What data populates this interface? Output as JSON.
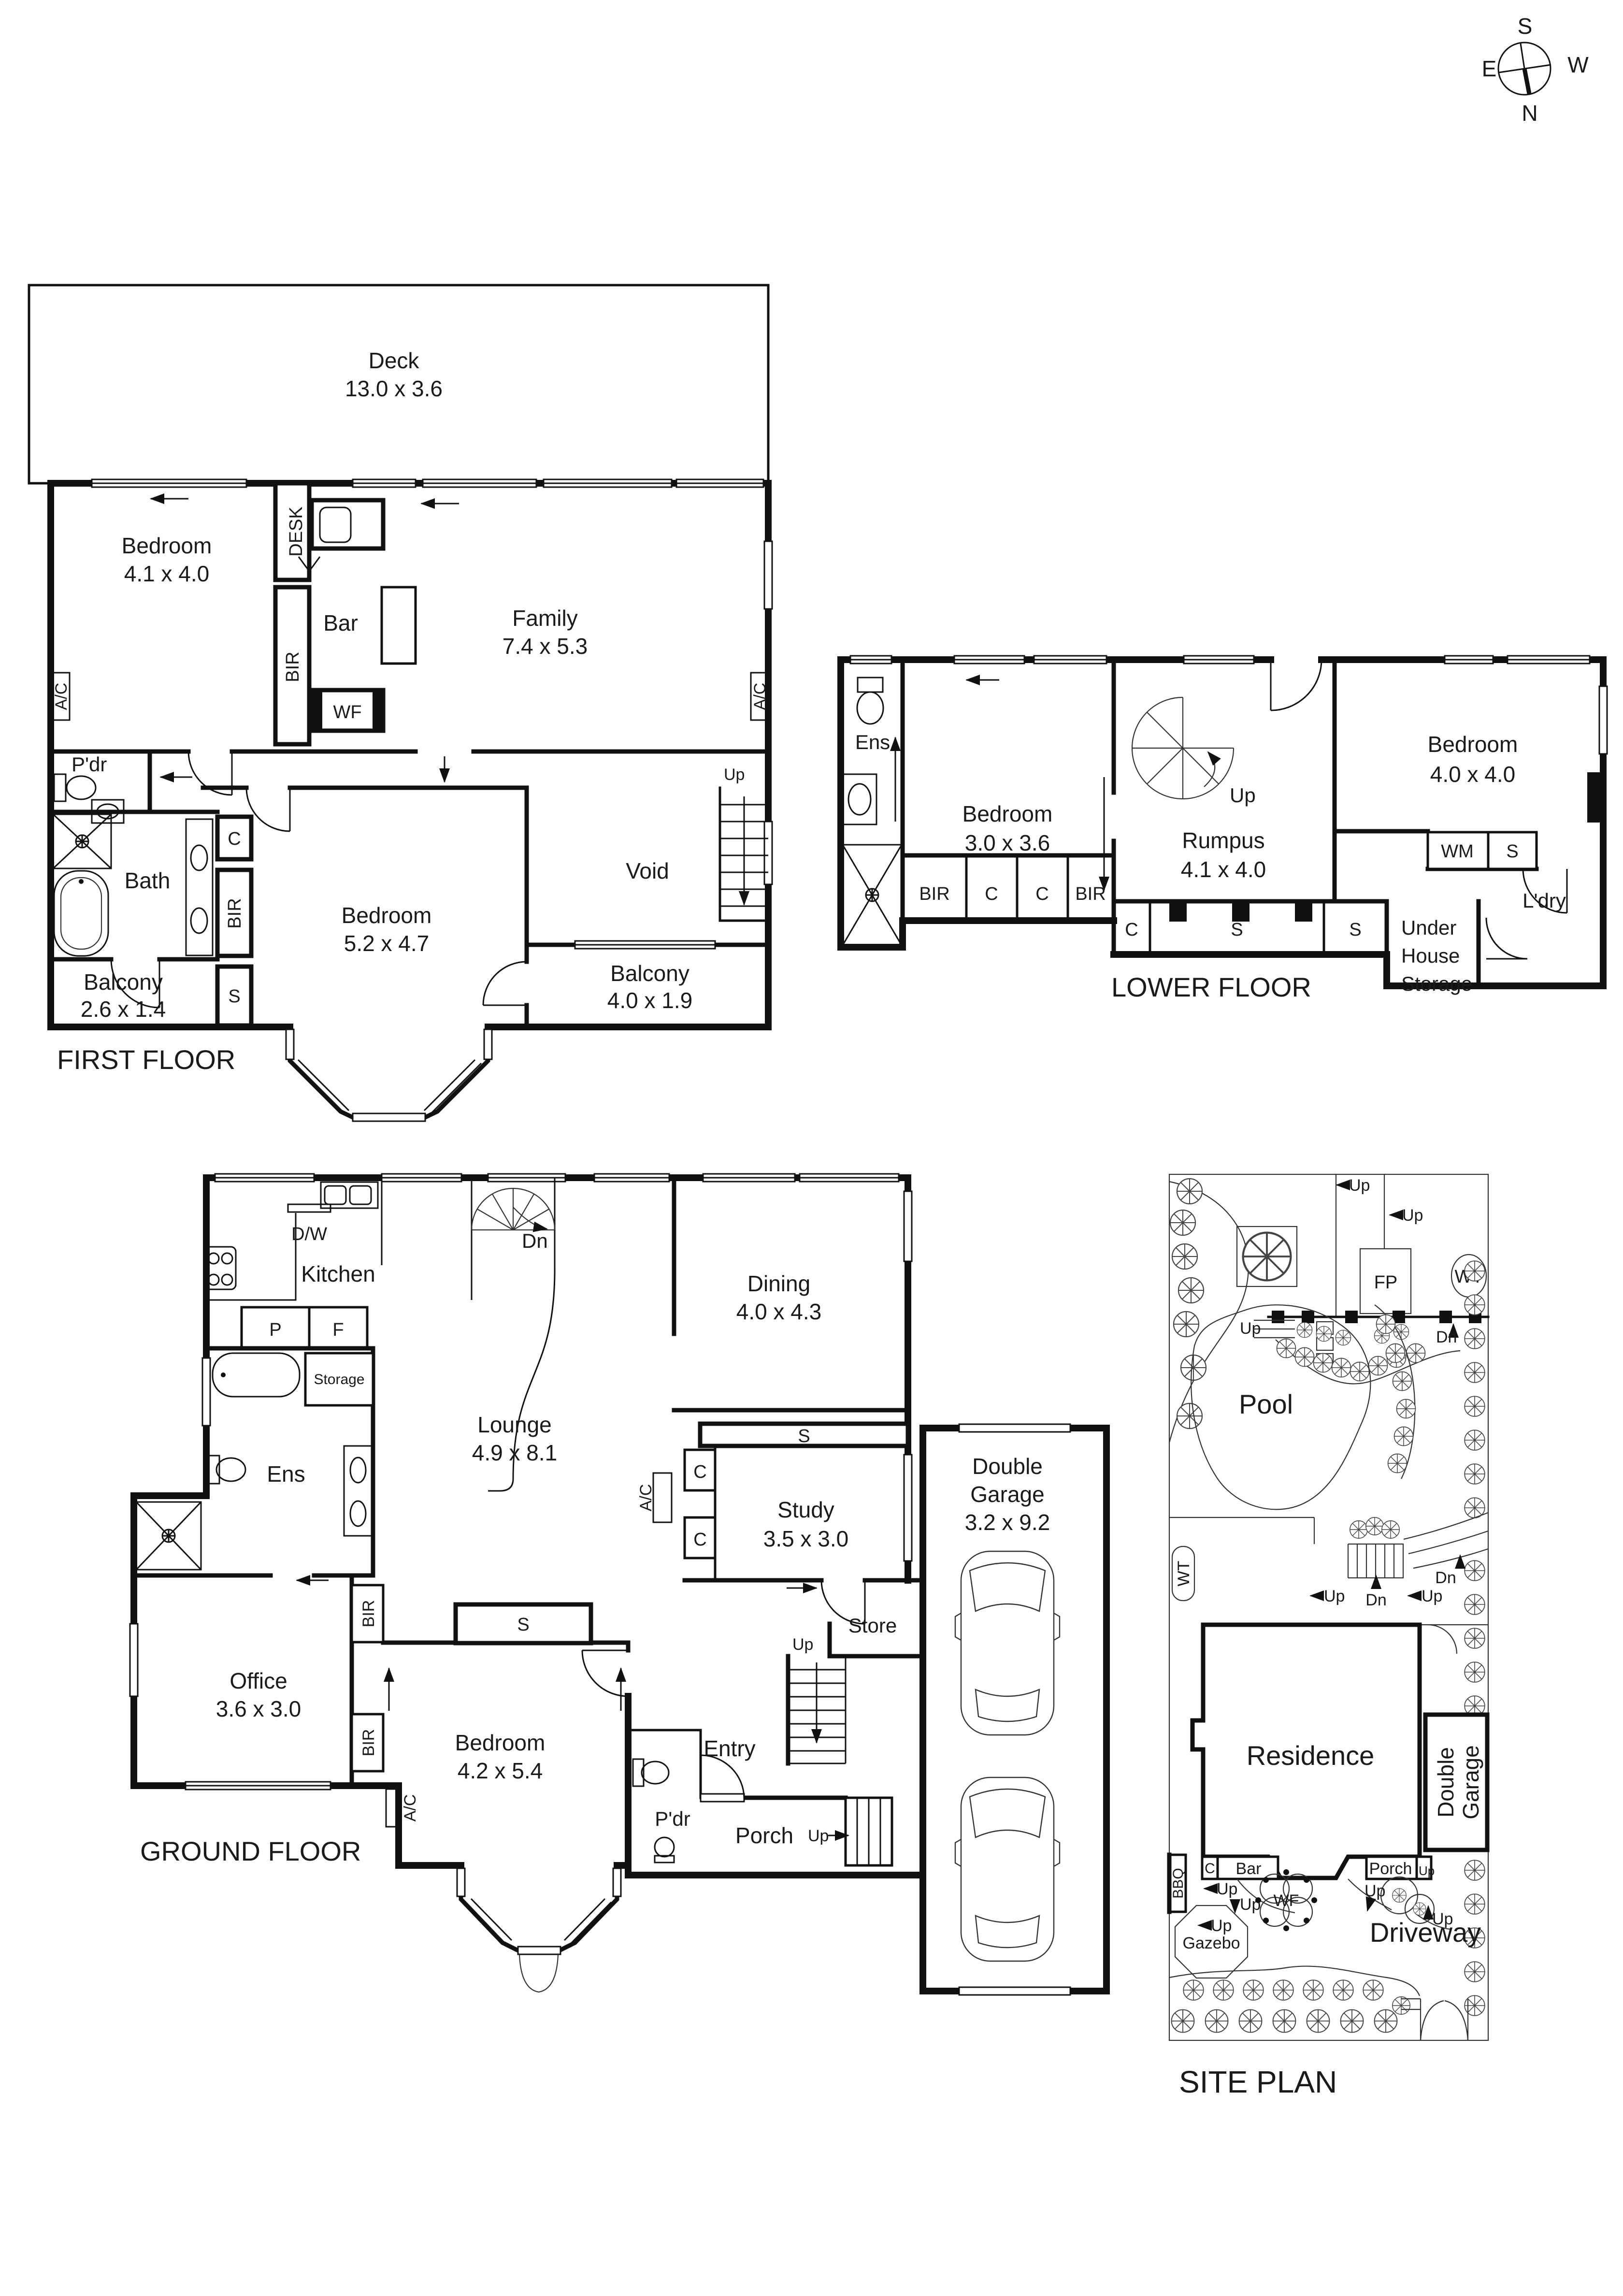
{
  "compass": {
    "s": "S",
    "n": "N",
    "e": "E",
    "w": "W"
  },
  "first_floor": {
    "title": "FIRST FLOOR",
    "deck": {
      "name": "Deck",
      "dim": "13.0 x 3.6"
    },
    "bedroom1": {
      "name": "Bedroom",
      "dim": "4.1 x 4.0"
    },
    "bedroom2": {
      "name": "Bedroom",
      "dim": "5.2 x 4.7"
    },
    "family": {
      "name": "Family",
      "dim": "7.4 x 5.3"
    },
    "balcony1": {
      "name": "Balcony",
      "dim": "2.6 x 1.4"
    },
    "balcony2": {
      "name": "Balcony",
      "dim": "4.0 x 1.9"
    },
    "labels": {
      "desk": "DESK",
      "bir": "BIR",
      "bar": "Bar",
      "wf": "WF",
      "ac": "A/C",
      "pdr": "P'dr",
      "bath": "Bath",
      "c": "C",
      "s": "S",
      "void": "Void",
      "up": "Up"
    }
  },
  "lower_floor": {
    "title": "LOWER FLOOR",
    "bedroom1": {
      "name": "Bedroom",
      "dim": "3.0 x 3.6"
    },
    "rumpus": {
      "name": "Rumpus",
      "dim": "4.1 x 4.0"
    },
    "bedroom2": {
      "name": "Bedroom",
      "dim": "4.0 x 4.0"
    },
    "storage": {
      "line1": "Under",
      "line2": "House",
      "line3": "Storage"
    },
    "labels": {
      "ens": "Ens",
      "up": "Up",
      "bir": "BIR",
      "c": "C",
      "s": "S",
      "wm": "WM",
      "ldry": "L'dry"
    }
  },
  "ground_floor": {
    "title": "GROUND FLOOR",
    "dining": {
      "name": "Dining",
      "dim": "4.0 x 4.3"
    },
    "lounge": {
      "name": "Lounge",
      "dim": "4.9 x 8.1"
    },
    "study": {
      "name": "Study",
      "dim": "3.5 x 3.0"
    },
    "garage": {
      "line1": "Double",
      "line2": "Garage",
      "dim": "3.2 x 9.2"
    },
    "office": {
      "name": "Office",
      "dim": "3.6 x 3.0"
    },
    "bedroom": {
      "name": "Bedroom",
      "dim": "4.2 x 5.4"
    },
    "labels": {
      "kitchen": "Kitchen",
      "dw": "D/W",
      "p": "P",
      "f": "F",
      "storage": "Storage",
      "ens": "Ens",
      "dn": "Dn",
      "up": "Up",
      "s": "S",
      "c": "C",
      "ac": "A/C",
      "bir": "BIR",
      "store": "Store",
      "entry": "Entry",
      "pdr": "P'dr",
      "porch": "Porch"
    }
  },
  "site_plan": {
    "title": "SITE PLAN",
    "labels": {
      "pool": "Pool",
      "residence": "Residence",
      "garage1": "Double",
      "garage2": "Garage",
      "driveway": "Driveway",
      "gazebo": "Gazebo",
      "wf": "WF",
      "fp": "FP",
      "wt": "WT",
      "bbq": "BBQ",
      "bar": "Bar",
      "c": "C",
      "porch": "Porch",
      "up": "Up",
      "dn": "Dn"
    }
  }
}
